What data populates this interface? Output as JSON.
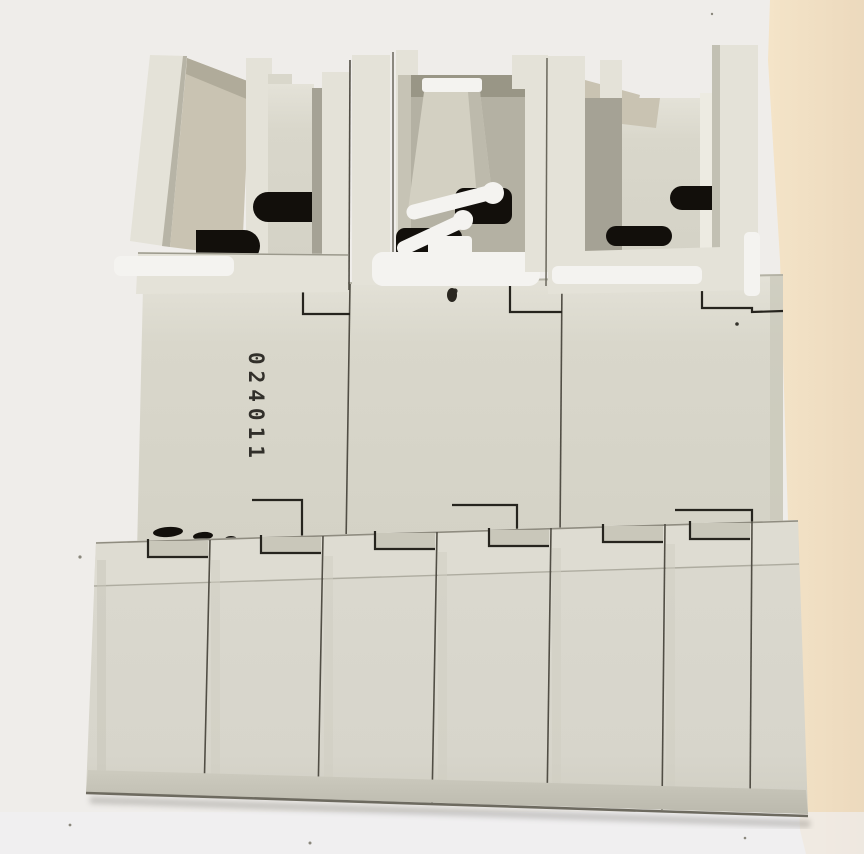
{
  "marking": {
    "text": "024011"
  },
  "colors": {
    "bg_left": "#efedea",
    "bg_warm_1": "#f4e4c8",
    "bg_warm_2": "#ecd9bd",
    "bg_bottom": "#eff0f2",
    "body": "#d9d7cb",
    "body_light": "#e4e2d8",
    "body_dark": "#a5a295",
    "bevel_tan": "#c9c3b2",
    "recess": "#b4b1a3",
    "recess_dark": "#999686",
    "slot_black": "#120f0b",
    "clip_white": "#f4f3f0",
    "seam": "#514e45",
    "line_dark": "#26241e",
    "edge_dark": "#6e6b60",
    "marking": "#1b1915"
  }
}
